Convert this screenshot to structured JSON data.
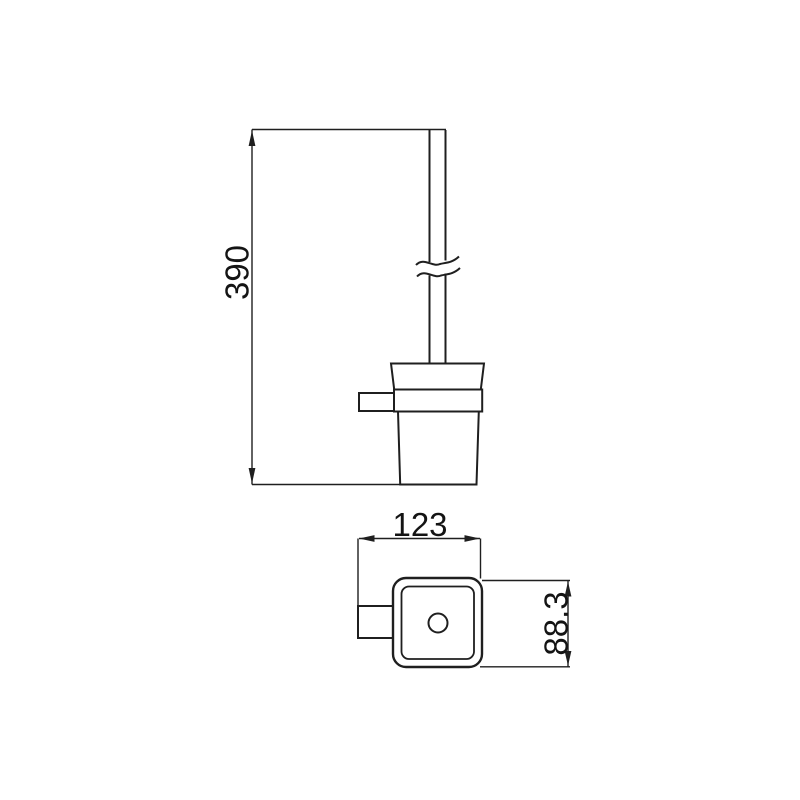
{
  "drawing": {
    "background_color": "#ffffff",
    "line_color": "#1f1f1f",
    "text_color": "#141414",
    "dimensions": {
      "height": "390",
      "width": "123",
      "depth": "88.3"
    }
  }
}
